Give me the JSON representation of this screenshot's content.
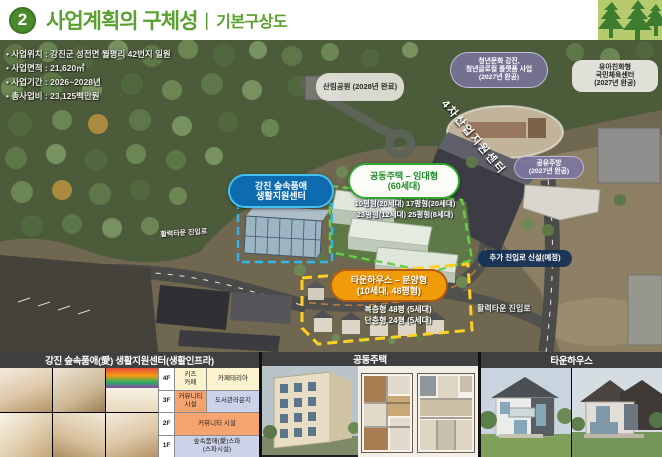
{
  "header": {
    "badge": "2",
    "title": "사업계획의 구체성",
    "divider": "|",
    "subtitle": "기본구상도"
  },
  "project_info": {
    "items": [
      "• 사업위치 : 강진군 성전면 월평리 42번지 일원",
      "• 사업면적 : 21,620㎡",
      "• 사업기간 : 2026~2028년",
      "• 총사업비 : 23,125백만원"
    ]
  },
  "map": {
    "labels": {
      "forest_park": "산림공원\n(2028년 완료)",
      "youth_platform": "청년문화 강진,\n청년글로컬 플랫폼 사업\n(2027년 완공)",
      "kids_sports_center": "유아친화형\n국민체육센터\n(2027년 완공)",
      "industry4_center": "4차산업지원센터",
      "shared_kitchen": "공유주방\n(2027년 완공)",
      "living_support_center": "강진 숲속품애\n생활지원센터",
      "apartment_rental": "공동주택 – 임대형\n(60세대)",
      "apartment_units_line1": "10평형(20세대)  17평형(20세대)",
      "apartment_units_line2": "23평형(12세대)  25평형(8세대)",
      "new_access_road": "추가 진입로 신설(예정)",
      "townhouse_sale": "타운하우스 – 분양형\n(10세대, 48평형)",
      "townhouse_units_line1": "복층형 48평 (5세대)",
      "townhouse_units_line2": "단층형 24평 (5세대)",
      "road_label_left": "활력타운 진입로",
      "road_label_right": "활력타운 진입로"
    }
  },
  "bottom": {
    "sections": [
      {
        "title": "강진 숲속품애(愛) 생활지원센터(생활인프라)"
      },
      {
        "title": "공동주택"
      },
      {
        "title": "타운하우스"
      }
    ],
    "floor_table": {
      "rows": [
        {
          "floor": "4F",
          "cell1": "키즈\n카페",
          "cell2": "카페테리아"
        },
        {
          "floor": "3F",
          "cell1": "커뮤니티\n시설",
          "cell2": "도서관라운지"
        },
        {
          "floor": "2F",
          "span": "커뮤니티 시설"
        },
        {
          "floor": "1F",
          "span": "숲속품애(愛)스파\n(스파시설)"
        }
      ]
    }
  },
  "colors": {
    "accent_green": "#5aa02e",
    "label_blue": "#0e6bb0",
    "label_orange": "#f09c0a",
    "label_purple": "#7c75a4",
    "label_navy": "#143056",
    "dash_blue": "#2fb7ee",
    "dash_green": "#69cf45",
    "dash_yellow": "#ffd023"
  }
}
